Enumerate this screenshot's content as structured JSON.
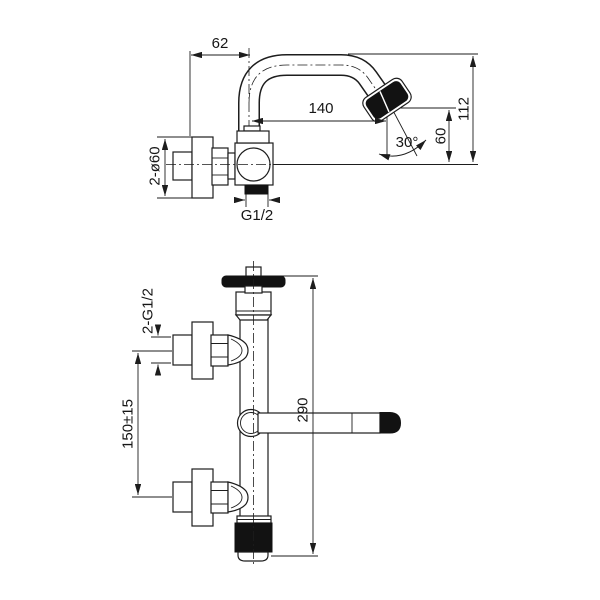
{
  "meta": {
    "background": "#ffffff",
    "line_color": "#1d1d1d",
    "black_fill": "#121212"
  },
  "top_view": {
    "description": "wall-mounted swivel spout faucet, side view",
    "offset_62": "62",
    "reach_140": "140",
    "height_112": "112",
    "drop_60": "60",
    "angle_30": "30°",
    "flange_2xd60": "2-ø60",
    "thread_g12": "G1/2"
  },
  "front_view": {
    "description": "bath mixer body, front view",
    "threads_2xg12": "2-G1/2",
    "centers_150": "150±15",
    "height_290": "290"
  }
}
